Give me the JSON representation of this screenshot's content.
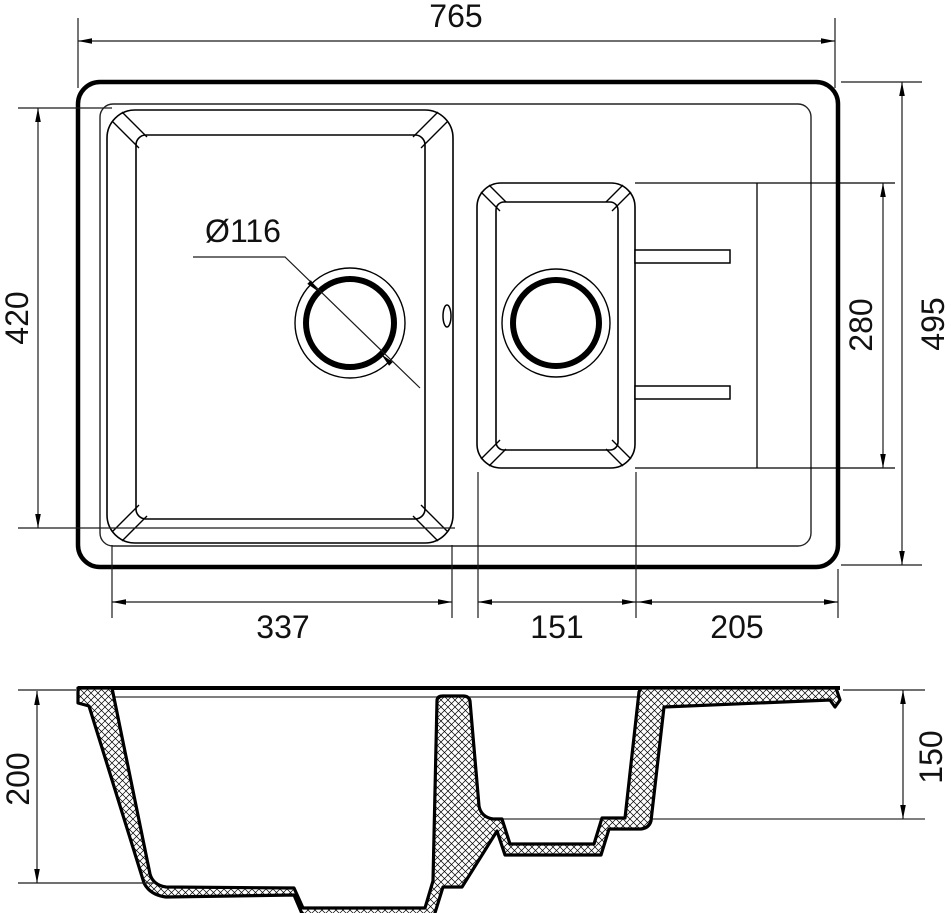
{
  "drawing": {
    "type": "kitchen sink technical drawing, top view and cross-section",
    "colors": {
      "line": "#000000",
      "background": "#ffffff",
      "text": "#111111"
    },
    "top_view": {
      "overall_width": "765",
      "overall_depth": "495",
      "main_bowl_length": "420",
      "small_bowl_length": "280",
      "main_bowl_width": "337",
      "small_bowl_width": "151",
      "drainer_width": "205",
      "drain_hole_diameter": "Ø116"
    },
    "section_view": {
      "main_bowl_depth": "200",
      "small_bowl_depth": "150"
    }
  }
}
